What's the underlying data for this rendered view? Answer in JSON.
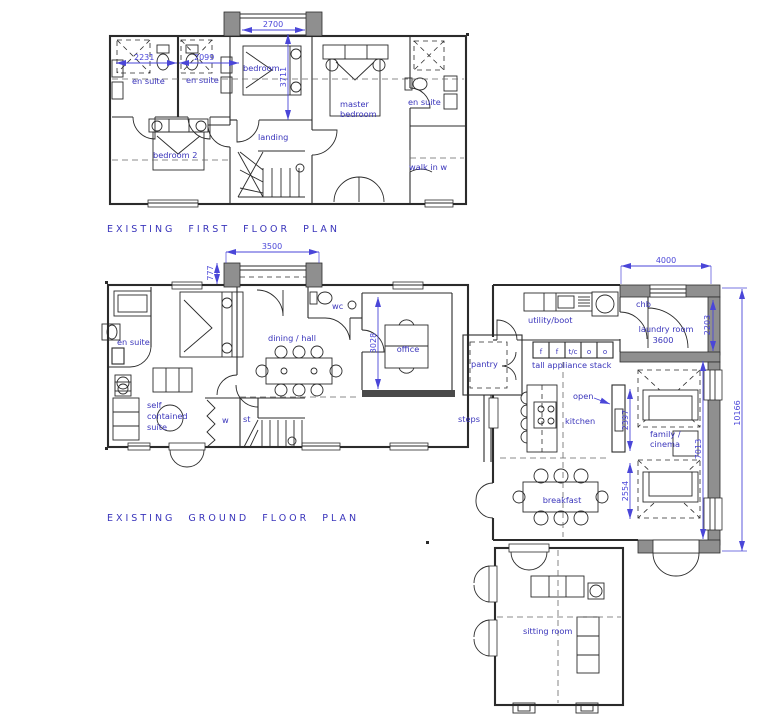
{
  "colors": {
    "ink": "#2b2b2b",
    "blue_text": "#3a35bb",
    "blue_dim": "#4a46d8",
    "wall_gray": "#8f8f8f",
    "wall_dark": "#4a4a4a",
    "bg": "#ffffff"
  },
  "first_floor": {
    "title": "EXISTING FIRST FLOOR PLAN",
    "labels": {
      "en_suite_left1": "en suite",
      "en_suite_left2": "en suite",
      "bedroom": "bedroom",
      "master_line1": "master",
      "master_line2": "bedroom",
      "en_suite_right": "en suite",
      "walk_in": "walk in w",
      "bedroom2": "bedroom 2",
      "landing": "landing"
    },
    "dims": {
      "dormer_width": "2700",
      "ensuite1_width": "2231",
      "ensuite2_width": "2099",
      "bedroom_depth": "3711"
    }
  },
  "ground_floor": {
    "title": "EXISTING GROUND FLOOR PLAN",
    "labels": {
      "en_suite": "en suite",
      "suite_line1": "self",
      "suite_line2": "contained",
      "suite_line3": "suite",
      "dining_hall": "dining / hall",
      "wc": "wc",
      "office": "office",
      "pantry": "pantry",
      "steps": "steps",
      "w_cupboard": "w",
      "store": "st",
      "utility": "utility/boot",
      "chb": "chb",
      "laundry_line1": "laundry room",
      "laundry_line2": "3600",
      "stack_label": "tall appliance stack",
      "stack_cells": [
        "f",
        "f",
        "t/c",
        "o",
        "o"
      ],
      "open": "open",
      "kitchen": "kitchen",
      "family_line1": "family /",
      "family_line2": "cinema",
      "breakfast": "breakfast",
      "sitting_room": "sitting room"
    },
    "dims": {
      "dormer_width": "3500",
      "dormer_depth": "777",
      "laundry_width": "4000",
      "laundry_depth": "2203",
      "office_depth": "3028",
      "kitchen_open": "2397",
      "breakfast_depth": "2554",
      "family_depth": "7013",
      "wing_length": "10166"
    }
  }
}
